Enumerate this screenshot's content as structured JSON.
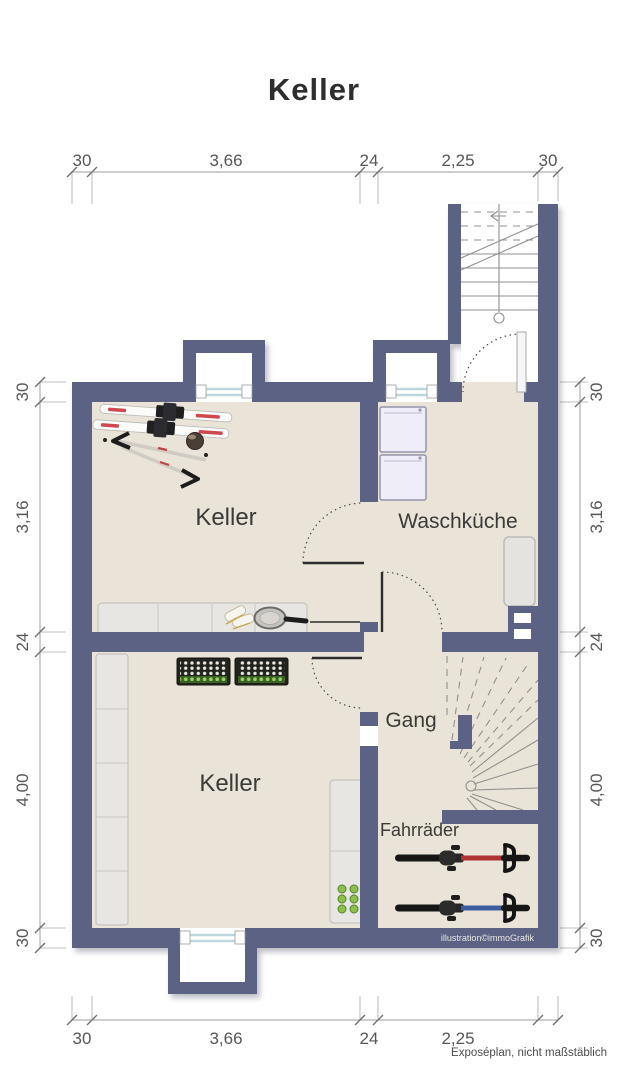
{
  "title": "Keller",
  "rooms": {
    "keller_top": "Keller",
    "waschkueche": "Waschküche",
    "keller_bottom": "Keller",
    "gang": "Gang",
    "fahrraeder": "Fahrräder"
  },
  "dimensions": {
    "top": [
      "30",
      "3,66",
      "24",
      "2,25",
      "30"
    ],
    "bottom": [
      "30",
      "3,66",
      "24",
      "2,25"
    ],
    "left": [
      "30",
      "3,16",
      "24",
      "4,00",
      "30"
    ],
    "right": [
      "30",
      "3,16",
      "24",
      "4,00",
      "30"
    ]
  },
  "footer": {
    "note": "Exposéplan, nicht maßstäblich"
  },
  "credit": "illustration©immoGrafik",
  "items": {
    "keller_top": [
      "skis",
      "ski-poles",
      "ski-helmet",
      "sideboard",
      "ice-skates",
      "tennis-racket"
    ],
    "keller_bottom": [
      "shelf-left",
      "beverage-crates",
      "shelf-right",
      "bottles"
    ],
    "waschkueche": [
      "washing-machine",
      "washing-machine",
      "cabinet"
    ],
    "fahrraeder": [
      "bicycle-red",
      "bicycle-blue"
    ],
    "stairs": [
      "staircase-upper",
      "staircase-winder"
    ]
  },
  "colors": {
    "wall": "#5b6283",
    "floor": "#e9e4d7",
    "stair": "#909090",
    "window": "#bcd8de",
    "shelf": "#e7e6e3",
    "machine": "#efeef8",
    "crate": "#23231d",
    "bottle_green": "#8cbf4e",
    "frame_red": "#b03232",
    "frame_blue": "#3c5c9e"
  }
}
